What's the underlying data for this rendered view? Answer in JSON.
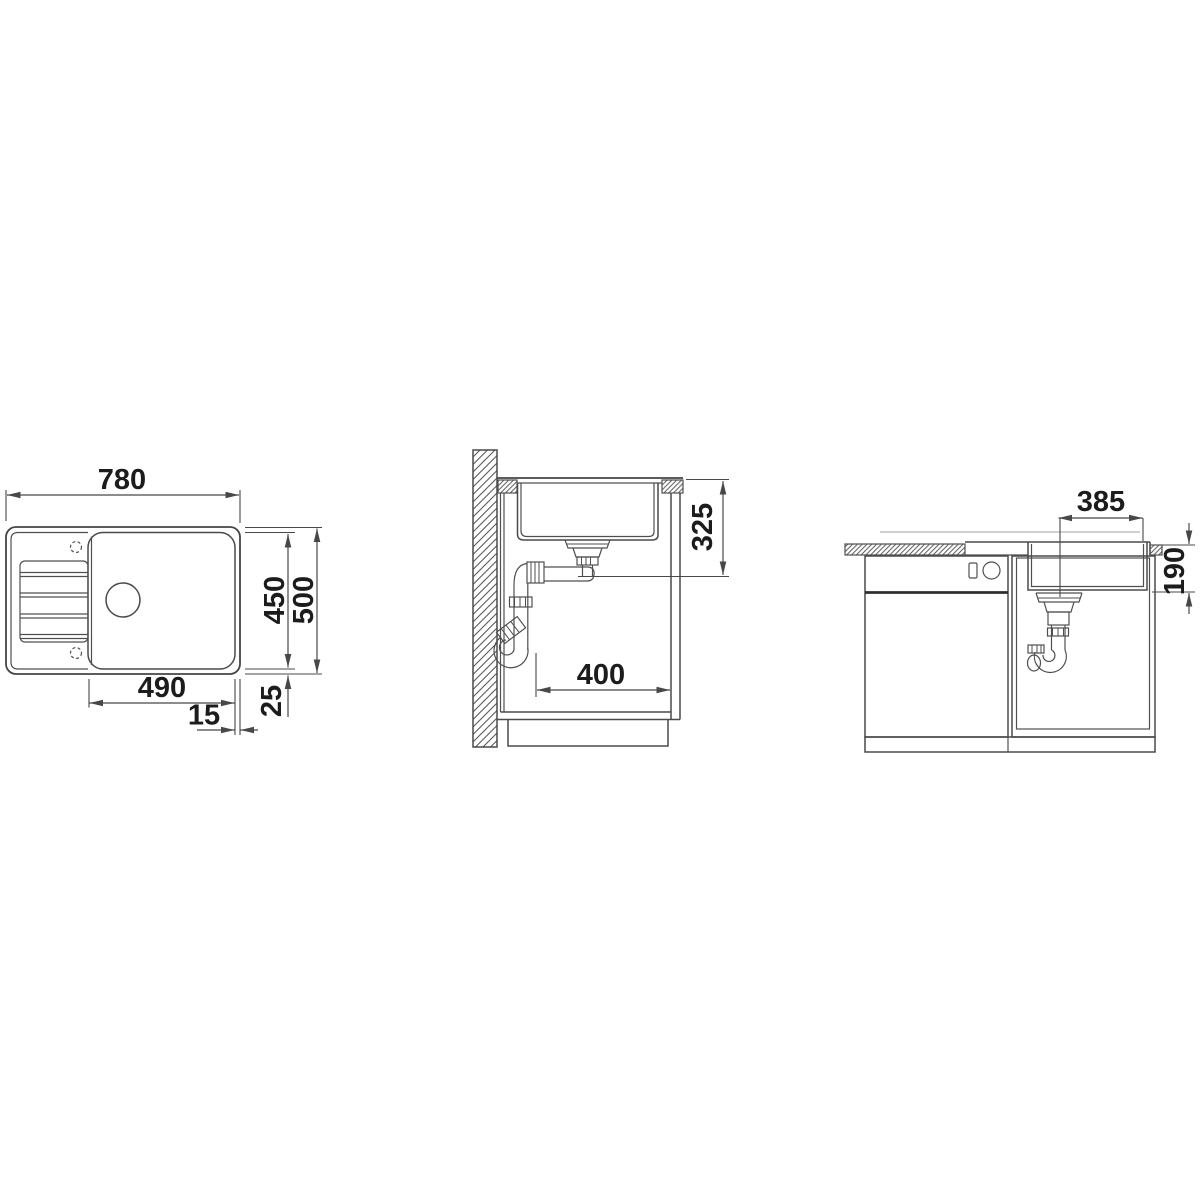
{
  "drawing_title": "sink-installation-dimension-drawing",
  "views": {
    "top": {
      "dims": {
        "overall_width": "780",
        "inner_depth": "450",
        "overall_depth": "500",
        "bowl_width": "490",
        "right_inset": "15",
        "bottom_inset": "25"
      }
    },
    "section": {
      "dims": {
        "depth_below_worktop": "325",
        "cabinet_clearance": "400"
      }
    },
    "front": {
      "dims": {
        "drain_center_to_edge": "385",
        "bowl_height": "190"
      }
    }
  },
  "colors": {
    "line": "#4a4a4a",
    "text": "#1c1c1c",
    "thick_line": "#2e2e2e",
    "faint_line": "#b5b5b5",
    "background": "#ffffff"
  }
}
